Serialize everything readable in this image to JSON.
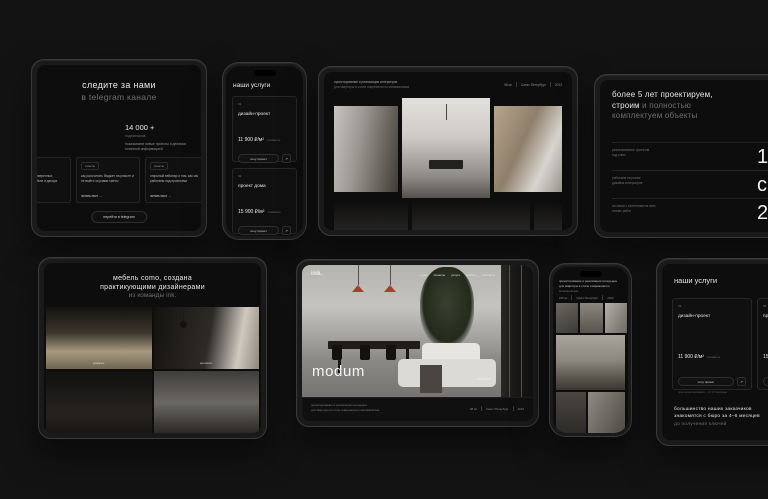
{
  "colors": {
    "page_bg": "#131313",
    "screen_bg": "#0d0d0d",
    "text_primary": "#e8e8e8",
    "text_muted": "#6f6f6f",
    "card_border": "#262626",
    "accent_lamp_red": "#a6402c"
  },
  "icons": {
    "arrow_up_right": "↗",
    "arrow_right": "→"
  },
  "telegram_tablet": {
    "heading_line1": "следите за нами",
    "heading_line2": "в telegram канале",
    "stat_value": "14 000 +",
    "stat_label": "подписчиков",
    "stat_caption": "показываем новые проекты и делимся полезной информацией",
    "cards": [
      {
        "tag": "советы",
        "text": "собрали базу проверенных поставщиков мебели и декора",
        "link": "читать пост"
      },
      {
        "tag": "советы",
        "text": "как рассчитать бюджет на ремонт и не выйти за рамки сметы",
        "link": "читать пост"
      },
      {
        "tag": "советы",
        "text": "открытый вебинар о том, как мы работаем над проектами",
        "link": "читать пост"
      }
    ],
    "button": "перейти в telegram"
  },
  "services_phone": {
    "title": "наши услуги",
    "cards": [
      {
        "num": "01",
        "name": "дизайн-проект",
        "price": "11 900 ₽/м²",
        "price_note": "стоимость",
        "button": "хочу проект",
        "caption": "срок проектирования — от 1,5 месяцев"
      },
      {
        "num": "02",
        "name": "проект дома",
        "price": "15 900 ₽/м²",
        "price_note": "стоимость",
        "button": "хочу проект",
        "caption": ""
      }
    ]
  },
  "gallery_tablet": {
    "desc_line1": "проектирование и реализация интерьеров",
    "desc_line2": "для квартиры в стиле современного минимализма",
    "meta_area": "98 м²",
    "meta_city": "Санкт-Петербург",
    "meta_year": "2023"
  },
  "stats_tablet": {
    "heading_white1": "более 5 лет проектируем,",
    "heading_white2": "строим",
    "heading_gray1": " и полностью",
    "heading_gray2": "комплектуем объекты",
    "note_line1": "за это время мы выстроили",
    "note_line2": "чёткий процесс работы",
    "stats": [
      {
        "label_line1": "реализованных проектов",
        "label_line2": "под ключ",
        "value": "100+"
      },
      {
        "label_line1": "работаем на рынке",
        "label_line2": "дизайна интерьеров",
        "value": "с 2018"
      },
      {
        "label_line1": "на связи с клиентами на всех",
        "label_line2": "этапах работ",
        "value": "24/7"
      }
    ]
  },
  "como_tablet": {
    "heading_line1": "мебель como, создана",
    "heading_line2": "практикующими дизайнерами",
    "heading_line3": "из команды ink.",
    "photo_labels": [
      "диваны",
      "кровати"
    ]
  },
  "modum_tablet": {
    "logo": "ink.",
    "nav": [
      "о нас",
      "проекты",
      "услуги",
      "мебель",
      "контакты"
    ],
    "title": "modum",
    "link": "смотреть",
    "desc_line1": "проектирование и реализация интерьера",
    "desc_line2": "для квартиры в стиле современного минимализма",
    "meta_area": "98 м²",
    "meta_city": "Санкт-Петербург",
    "meta_year": "2023"
  },
  "project_phone": {
    "desc_line1": "проектирование и реализация интерьера",
    "desc_line2": "для квартиры в стиле современного",
    "desc_line3": "минимализма",
    "meta_area": "100 м²",
    "meta_city": "Санкт-Петербург",
    "meta_year": "2023"
  },
  "services_tablet": {
    "title": "наши услуги",
    "cards": [
      {
        "num": "01",
        "name": "дизайн-проект",
        "price": "11 900 ₽/м²",
        "price_note": "стоимость",
        "button": "хочу проект",
        "caption": "срок проектирования — от 1,5 месяцев"
      },
      {
        "num": "02",
        "name": "проект дома",
        "price": "15 900 ₽/м²",
        "price_note": "стоимость",
        "button": "хочу проект",
        "caption": ""
      }
    ],
    "footer_line1": "большинство наших заказчиков",
    "footer_line2": "знакомятся с бюро за 4–6 месяцев",
    "footer_line3": "до получения ключей"
  }
}
